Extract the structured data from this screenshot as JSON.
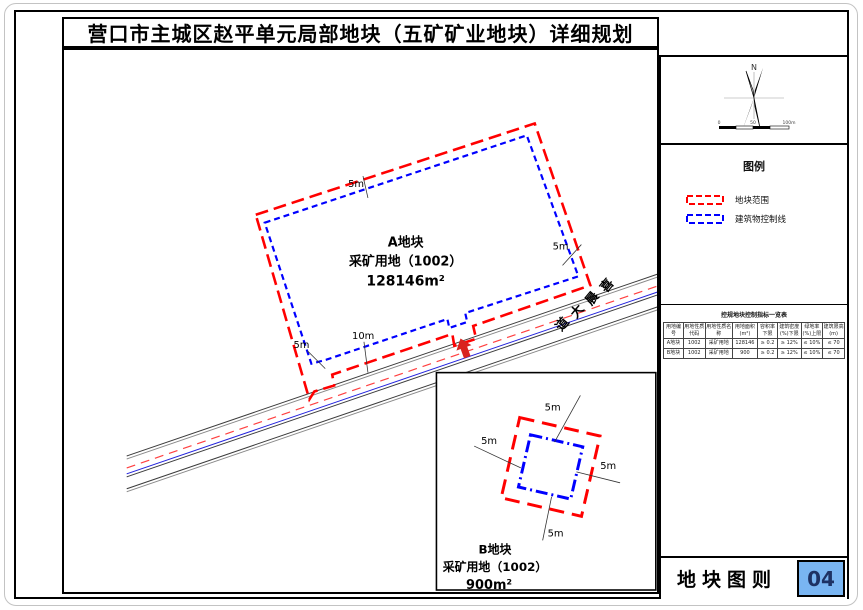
{
  "title": "营口市主城区赵平单元局部地块（五矿矿业地块）详细规划",
  "colors": {
    "boundary_red": "#ff0000",
    "control_blue": "#0000ff",
    "road_centerline_red": "#ff4040",
    "arrow_red": "#d9231e",
    "sheet_no_bg": "#79b5f2",
    "sheet_no_text": "#1e3264"
  },
  "map": {
    "plot_a": {
      "name": "A地块",
      "use": "采矿用地（1002）",
      "area": "128146m²"
    },
    "plot_b": {
      "name": "B地块",
      "use": "采矿用地（1002）",
      "area": "900m²"
    },
    "road": {
      "name": "喜晨大道",
      "chars": [
        "喜",
        "晨",
        "大",
        "道"
      ]
    },
    "dims": {
      "a_top": "5m",
      "a_right": "5m",
      "a_left": "5m",
      "a_bottom": "10m",
      "b_top": "5m",
      "b_left": "5m",
      "b_right": "5m",
      "b_bottom": "5m"
    }
  },
  "sidebar": {
    "compass": {
      "north_label": "N",
      "scale_labels": [
        "0",
        "50",
        "100m"
      ]
    },
    "legend": {
      "title": "图例",
      "items": [
        {
          "label": "地块范围",
          "color": "#ff0000"
        },
        {
          "label": "建筑物控制线",
          "color": "#0000ff"
        }
      ]
    },
    "table": {
      "title": "控规地块控制指标一览表",
      "headers": [
        "用地编号",
        "用地性质代码",
        "用地性质名称",
        "用地面积(m²)",
        "容积率下限",
        "建筑密度(%)下限",
        "绿地率(%)上限",
        "建筑限高(m)"
      ],
      "rows": [
        [
          "A地块",
          "1002",
          "采矿用地",
          "128146",
          "≥ 0.2",
          "≥ 12%",
          "≤ 10%",
          "≤ 70"
        ],
        [
          "B地块",
          "1002",
          "采矿用地",
          "900",
          "≥ 0.2",
          "≥ 12%",
          "≤ 10%",
          "≤ 70"
        ]
      ]
    },
    "titleblock": {
      "label": "地块图则",
      "number": "04"
    }
  }
}
